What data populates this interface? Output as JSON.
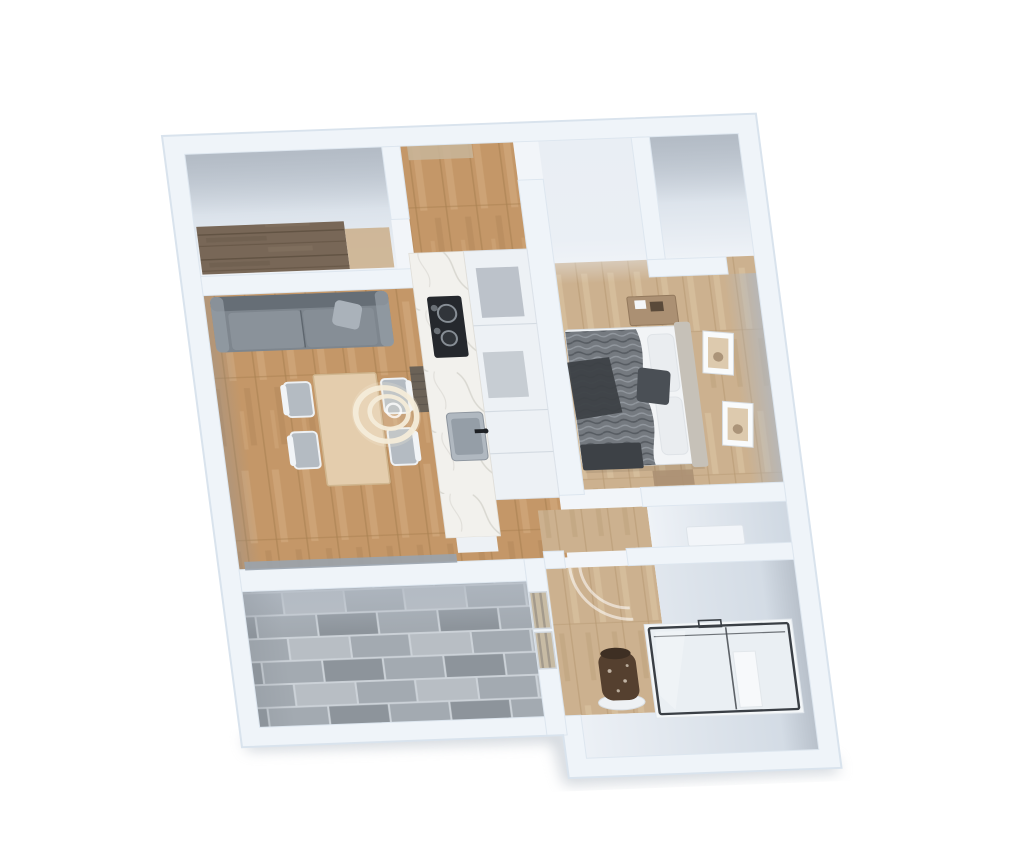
{
  "scene": {
    "kind": "3d-floorplan-render",
    "view": "top-down, slightly rotated",
    "rooms": [
      {
        "name": "entry-closet",
        "floor": "white with dark-wood wardrobe"
      },
      {
        "name": "living-dining-room",
        "floor": "oak"
      },
      {
        "name": "kitchen",
        "floor": "oak"
      },
      {
        "name": "walk-in-closet",
        "floor": "white"
      },
      {
        "name": "bedroom",
        "floor": "light wood"
      },
      {
        "name": "hallway",
        "floor": "light wood"
      },
      {
        "name": "terrace",
        "floor": "gray stone tile"
      },
      {
        "name": "bathroom",
        "floor": "light wood and white"
      }
    ],
    "furniture": [
      "gray-sofa",
      "dining-table",
      "four-chairs",
      "pendant-ring-lamp",
      "marble-counter",
      "cooktop",
      "kitchen-sink",
      "tall-cabinet-row",
      "double-bed",
      "dresser",
      "two-wall-pictures",
      "foot-bench",
      "glass-shower-cabin",
      "shower-column",
      "planter-vase",
      "radiator-shelf",
      "glazed-door",
      "sliding-window"
    ]
  },
  "colors": {
    "bg": "#ffffff",
    "wall": "#eff4f9",
    "wall_edge": "#d9e3ed",
    "wall_face": "#b7bec8",
    "floor_white": "#e9eef4",
    "floor_white_dark": "#c8d1db",
    "wood_oak": "#c49768",
    "wood_oak_light": "#d4ab7e",
    "wood_oak_dark": "#a87f50",
    "wood_light": "#ccb18f",
    "wood_light_light": "#dac4a4",
    "wood_light_dark": "#b3966f",
    "wood_dark": "#786757",
    "wood_dark_line": "#5d4e3e",
    "tile_grout": "#ccd2d8",
    "tile_base": "#a3aab1",
    "tile_light": "#b8bec4",
    "tile_dark": "#8d949b",
    "sofa": "#7e868e",
    "sofa_light": "#969ea6",
    "sofa_dark": "#666e76",
    "pillow": "#aab2ba",
    "table": "#e4cdad",
    "table_edge": "#d0b68f",
    "chair_seat": "#b4bbc2",
    "chair_frame": "#f1f4f7",
    "pendant": "#f4ecd9",
    "marble": "#f2f1ed",
    "marble_vein": "#d3d2cb",
    "cooktop": "#25282d",
    "burner": "#878e95",
    "sink": "#b0b8c0",
    "sink_dark": "#959ea7",
    "faucet": "#1d2024",
    "unit": "#edf1f5",
    "unit_panel": "#b6bdc5",
    "bed_white": "#f2f4f6",
    "blanket": "#757a80",
    "blanket_dark": "#565b61",
    "throw": "#3d4146",
    "headboard": "#c6c1b8",
    "pillow_white": "#eaedf0",
    "frame": "#f9fbfc",
    "art": "#ddcaae",
    "art_dark": "#8a6f55",
    "dresser": "#ab9073",
    "glass": "#dce5ec",
    "glass_frame": "#3a3f45",
    "vase": "#55402f",
    "vase_speck": "#d3c8b8",
    "ledge": "#f2f5f9",
    "shadow": "#a9b2bd",
    "window_track": "#9aa3ad",
    "mat": "#c8b59a"
  }
}
